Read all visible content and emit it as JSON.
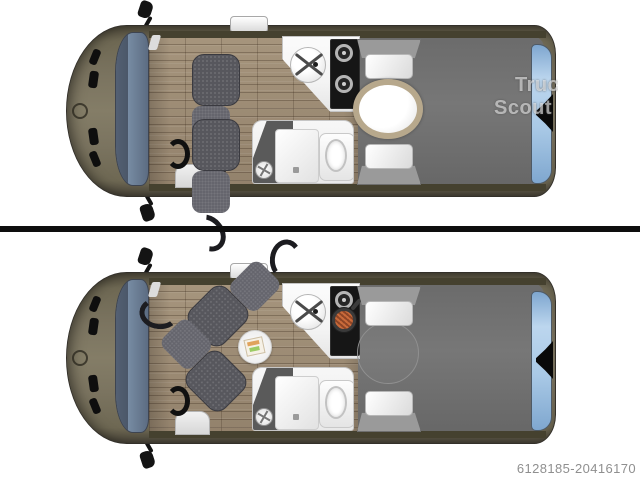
{
  "page": {
    "background": "#ffffff",
    "listing_id": "6128185-20416170",
    "watermark": {
      "line1": "Truc",
      "line2": "Scout"
    }
  },
  "colors": {
    "body-olive": "#7b7460",
    "body-olive-dark": "#4b463a",
    "outline": "#33302a",
    "wall-olive": "#45412f",
    "wood-light": "#a6957d",
    "wood-dark": "#93826c",
    "bed-gray": "#777777",
    "seat-gray": "#57575d",
    "seat-dark": "#1c1c20",
    "windshield-blue": "#74889f",
    "rear-window-blue": "#a9c9e6",
    "furniture-white": "#f4f4f4",
    "stove-black": "#161616",
    "table-rim-tan": "#b7a88c",
    "divider-black": "#0e0e0e",
    "id-text-gray": "#8f8f8f"
  },
  "floorplans": [
    {
      "position": "top",
      "layout": "seats-forward-dining-table"
    },
    {
      "position": "bottom",
      "layout": "seats-swiveled-bed-mode"
    }
  ]
}
